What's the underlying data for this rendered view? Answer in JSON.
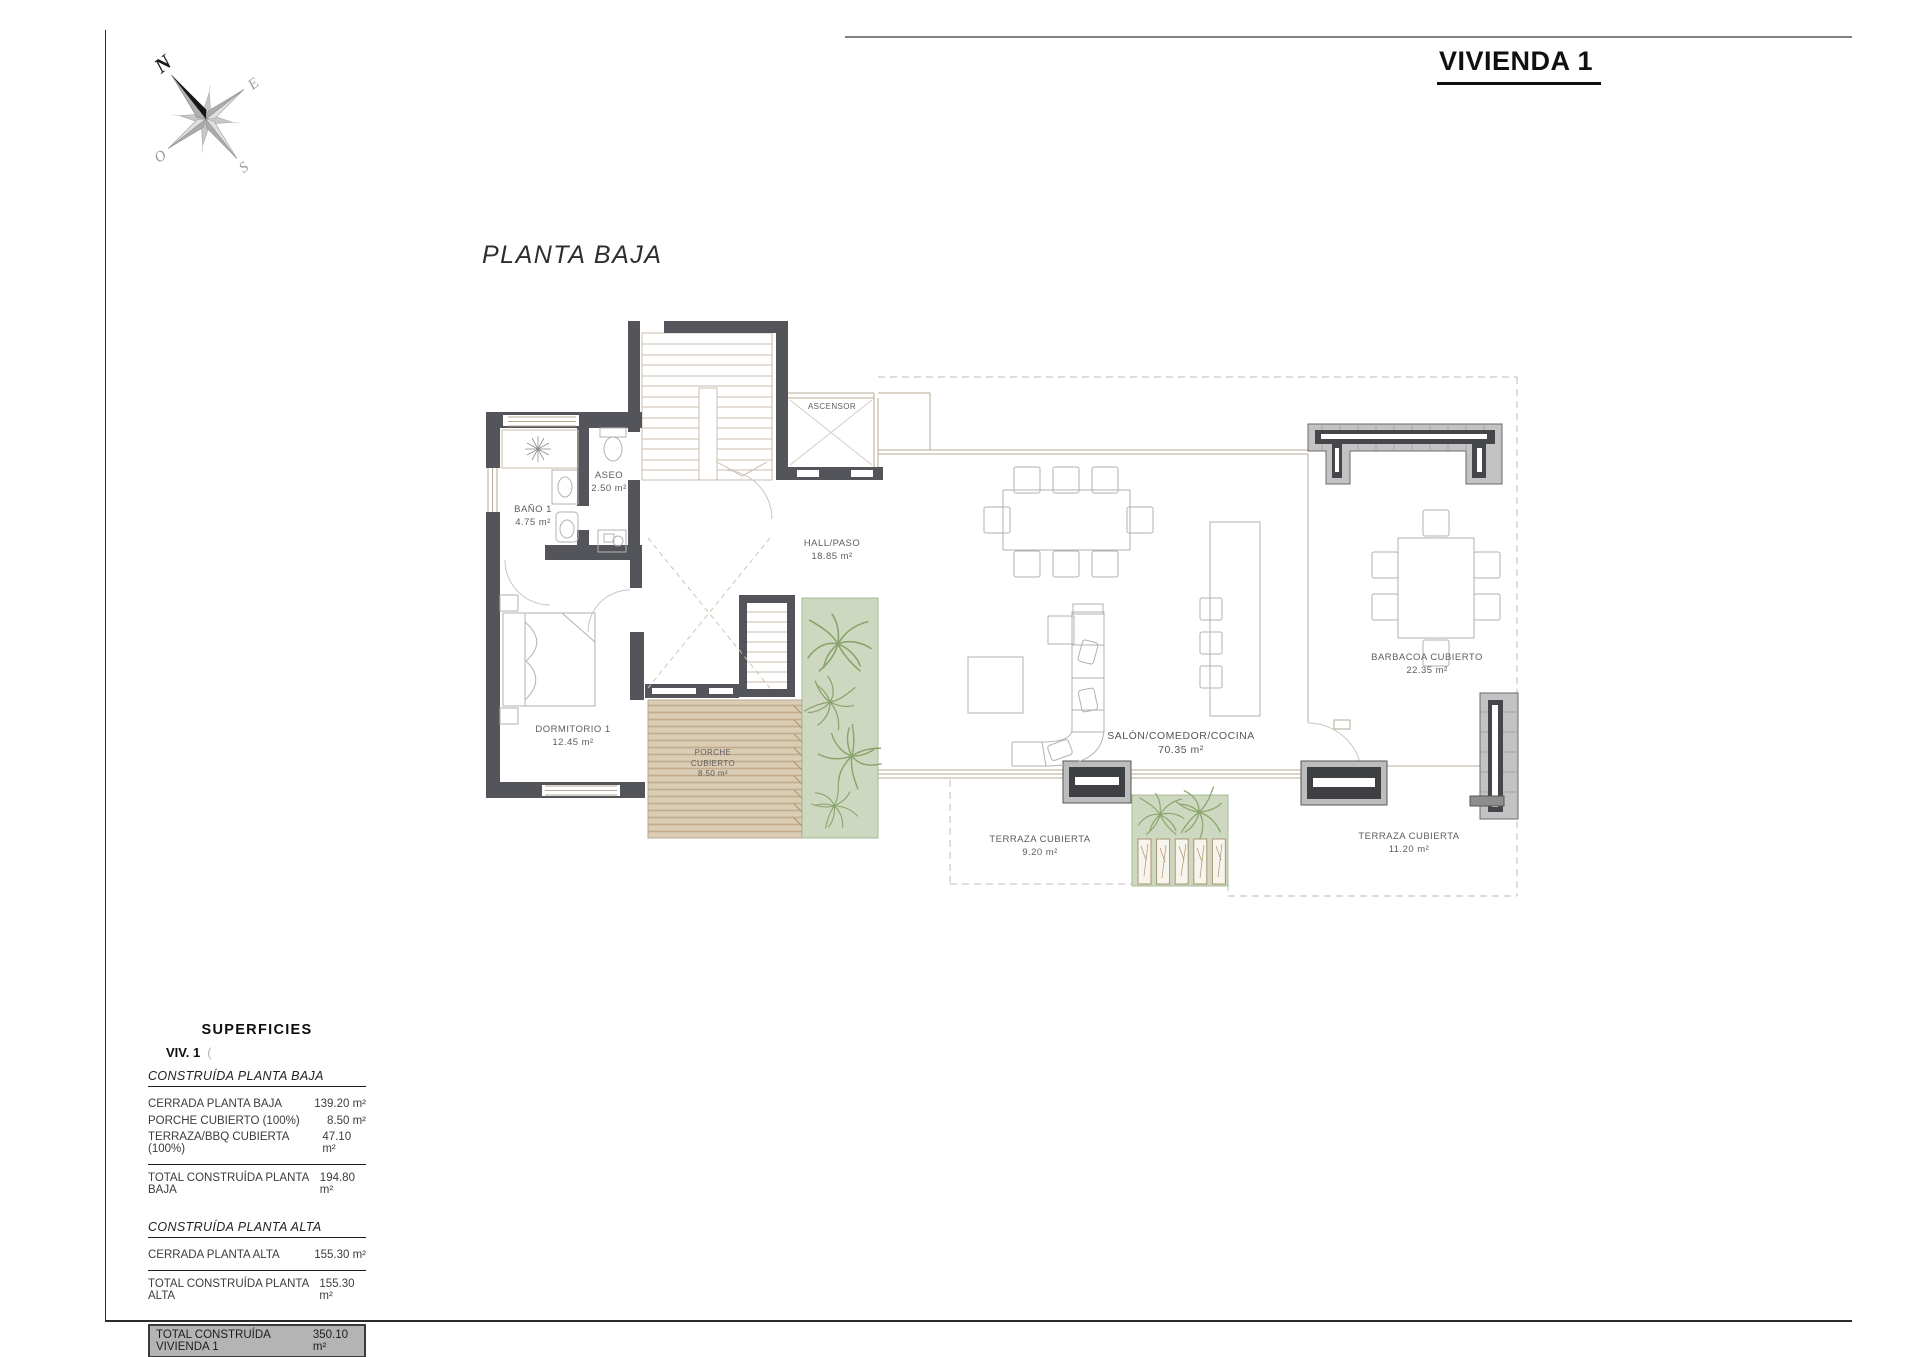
{
  "sheet": {
    "title": "VIVIENDA 1",
    "plan_label": "PLANTA BAJA"
  },
  "compass": {
    "n": "N",
    "o": "O",
    "e": "E",
    "s": "S"
  },
  "rooms": {
    "ascensor": {
      "name": "ASCENSOR"
    },
    "aseo": {
      "name": "ASEO",
      "area": "2.50 m²"
    },
    "bano": {
      "name": "BAÑO 1",
      "area": "4.75 m²"
    },
    "hall": {
      "name": "HALL/PASO",
      "area": "18.85 m²"
    },
    "dormitorio": {
      "name": "DORMITORIO 1",
      "area": "12.45 m²"
    },
    "porche": {
      "line1": "PORCHE",
      "line2": "CUBIERTO",
      "area": "8.50 m²"
    },
    "salon": {
      "name": "SALÓN/COMEDOR/COCINA",
      "area": "70.35 m²"
    },
    "barbacoa": {
      "name": "BARBACOA CUBIERTO",
      "area": "22.35 m²"
    },
    "terraza_izq": {
      "name": "TERRAZA CUBIERTA",
      "area": "9.20 m²"
    },
    "terraza_der": {
      "name": "TERRAZA CUBIERTA",
      "area": "11.20 m²"
    }
  },
  "superficies": {
    "title": "SUPERFICIES",
    "subtitle": "VIV. 1",
    "subtitle_suffix": "(",
    "planta_baja": {
      "heading": "CONSTRUÍDA PLANTA BAJA",
      "rows": [
        {
          "label": "CERRADA PLANTA BAJA",
          "value": "139.20 m²"
        },
        {
          "label": "PORCHE CUBIERTO (100%)",
          "value": "8.50 m²"
        },
        {
          "label": "TERRAZA/BBQ CUBIERTA (100%)",
          "value": "47.10 m²"
        }
      ],
      "total": {
        "label": "TOTAL CONSTRUÍDA PLANTA BAJA",
        "value": "194.80 m²"
      }
    },
    "planta_alta": {
      "heading": "CONSTRUÍDA PLANTA ALTA",
      "rows": [
        {
          "label": "CERRADA PLANTA ALTA",
          "value": "155.30 m²"
        }
      ],
      "total": {
        "label": "TOTAL CONSTRUÍDA PLANTA ALTA",
        "value": "155.30 m²"
      }
    },
    "grand_total": {
      "label": "TOTAL CONSTRUÍDA VIVIENDA 1",
      "value": "350.10 m²"
    }
  },
  "colors": {
    "wall_dark": "#54555a",
    "stone_wall": "#c3c3c3",
    "wood_deck": "#dbccb4",
    "planting_green": "#ced8c1",
    "highlight_gray": "#b4b4b4",
    "accent_black": "#111111"
  }
}
